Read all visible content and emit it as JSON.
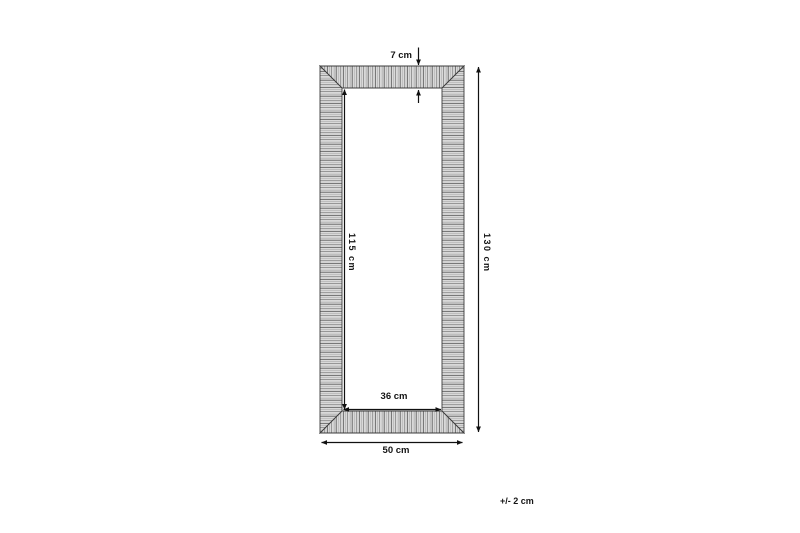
{
  "diagram": {
    "title": "mirror-frame-dimension-diagram",
    "labels": {
      "frame_width": "7 cm",
      "inner_height": "115 cm",
      "outer_height": "130 cm",
      "inner_width": "36 cm",
      "outer_width": "50 cm",
      "tolerance": "+/- 2 cm"
    },
    "dimensions": {
      "frame_width_cm": 7,
      "inner_height_cm": 115,
      "outer_height_cm": 130,
      "inner_width_cm": 36,
      "outer_width_cm": 50,
      "tolerance_cm": 2
    },
    "colors": {
      "background": "#ffffff",
      "frame_fill": "#d9d9d9",
      "hatch_line": "#9a9a9a",
      "outline": "#3c3c3c",
      "dimension": "#111111",
      "text": "#141414"
    }
  }
}
